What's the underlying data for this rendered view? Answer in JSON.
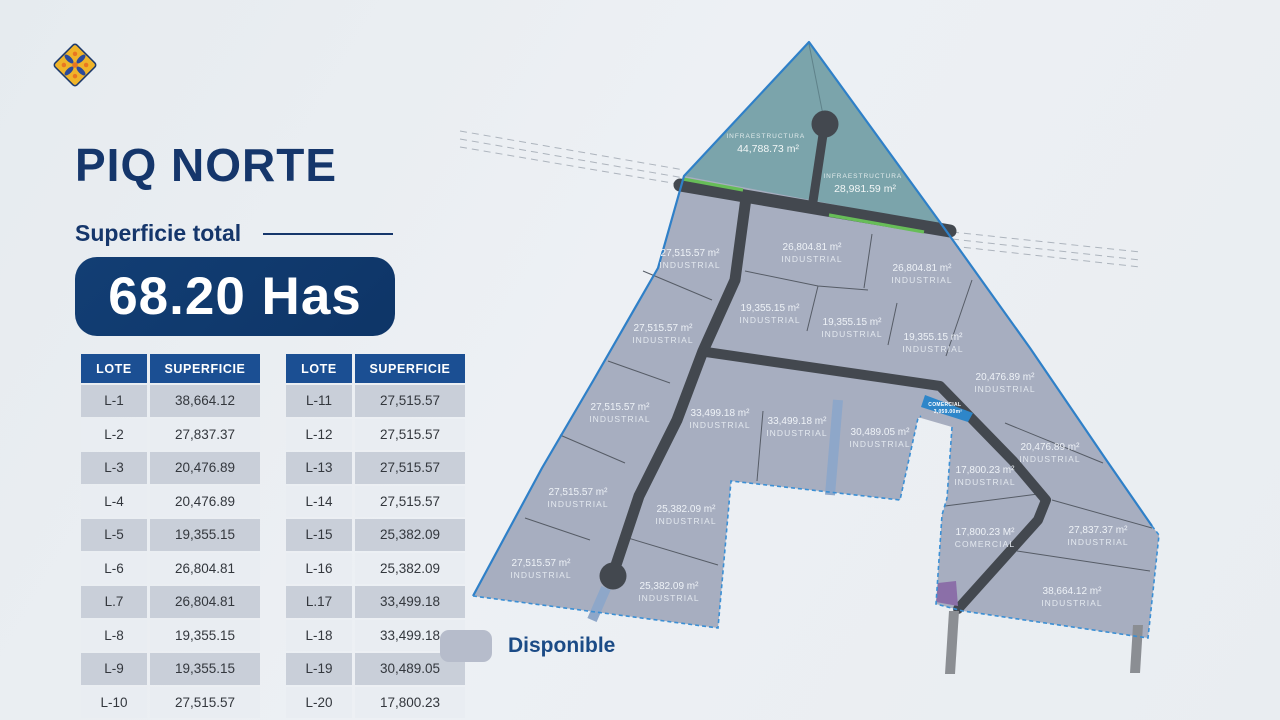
{
  "brand": {
    "logo_icon": "flower-diamond-icon",
    "title": "PIQ NORTE"
  },
  "summary": {
    "label": "Superficie total",
    "value": "68.20 Has"
  },
  "tables": {
    "headers": {
      "lot": "LOTE",
      "area": "SUPERFICIE"
    },
    "left": [
      {
        "lot": "L-1",
        "area": "38,664.12"
      },
      {
        "lot": "L-2",
        "area": "27,837.37"
      },
      {
        "lot": "L-3",
        "area": "20,476.89"
      },
      {
        "lot": "L-4",
        "area": "20,476.89"
      },
      {
        "lot": "L-5",
        "area": "19,355.15"
      },
      {
        "lot": "L-6",
        "area": "26,804.81"
      },
      {
        "lot": "L.7",
        "area": "26,804.81"
      },
      {
        "lot": "L-8",
        "area": "19,355.15"
      },
      {
        "lot": "L-9",
        "area": "19,355.15"
      },
      {
        "lot": "L-10",
        "area": "27,515.57"
      }
    ],
    "right": [
      {
        "lot": "L-11",
        "area": "27,515.57"
      },
      {
        "lot": "L-12",
        "area": "27,515.57"
      },
      {
        "lot": "L-13",
        "area": "27,515.57"
      },
      {
        "lot": "L-14",
        "area": "27,515.57"
      },
      {
        "lot": "L-15",
        "area": "25,382.09"
      },
      {
        "lot": "L-16",
        "area": "25,382.09"
      },
      {
        "lot": "L.17",
        "area": "33,499.18"
      },
      {
        "lot": "L-18",
        "area": "33,499.18"
      },
      {
        "lot": "L-19",
        "area": "30,489.05"
      },
      {
        "lot": "L-20",
        "area": "17,800.23"
      }
    ]
  },
  "legend": {
    "label": "Disponible",
    "swatch_color": "#b6bccb"
  },
  "map": {
    "infrastructure": [
      {
        "label": "INFRAESTRUCTURA",
        "area": "44,788.73 m²"
      },
      {
        "label": "INFRAESTRUCTURA",
        "area": "28,981.59 m²"
      }
    ],
    "commercial_small": {
      "label": "COMERCIAL",
      "area": "3,059.00m²"
    },
    "lots": [
      {
        "area": "27,515.57 m²",
        "type": "INDUSTRIAL"
      },
      {
        "area": "26,804.81 m²",
        "type": "INDUSTRIAL"
      },
      {
        "area": "26,804.81 m²",
        "type": "INDUSTRIAL"
      },
      {
        "area": "19,355.15 m²",
        "type": "INDUSTRIAL"
      },
      {
        "area": "19,355.15 m²",
        "type": "INDUSTRIAL"
      },
      {
        "area": "19,355.15 m²",
        "type": "INDUSTRIAL"
      },
      {
        "area": "27,515.57 m²",
        "type": "INDUSTRIAL"
      },
      {
        "area": "20,476.89 m²",
        "type": "INDUSTRIAL"
      },
      {
        "area": "27,515.57 m²",
        "type": "INDUSTRIAL"
      },
      {
        "area": "33,499.18 m²",
        "type": "INDUSTRIAL"
      },
      {
        "area": "33,499.18 m²",
        "type": "INDUSTRIAL"
      },
      {
        "area": "30,489.05 m²",
        "type": "INDUSTRIAL"
      },
      {
        "area": "20,476.89 m²",
        "type": "INDUSTRIAL"
      },
      {
        "area": "17,800.23 m²",
        "type": "INDUSTRIAL"
      },
      {
        "area": "27,515.57 m²",
        "type": "INDUSTRIAL"
      },
      {
        "area": "25,382.09 m²",
        "type": "INDUSTRIAL"
      },
      {
        "area": "27,837.37 m²",
        "type": "INDUSTRIAL"
      },
      {
        "area": "17,800.23 M²",
        "type": "COMERCIAL"
      },
      {
        "area": "27,515.57 m²",
        "type": "INDUSTRIAL"
      },
      {
        "area": "25,382.09 m²",
        "type": "INDUSTRIAL"
      },
      {
        "area": "38,664.12 m²",
        "type": "INDUSTRIAL"
      }
    ]
  },
  "colors": {
    "navy": "#15366b",
    "header_blue": "#1b4f93",
    "boundary_blue": "#2f80c8",
    "lot_gray": "#a7aec0",
    "infra_teal": "#7ba4ab",
    "road_dark": "#43484f",
    "green_strip": "#67bd58",
    "commercial_blue": "#2e86c9",
    "purple_lot": "#8b6fa8",
    "row_dark": "#c9cfd9",
    "row_light": "#e9edf2"
  }
}
